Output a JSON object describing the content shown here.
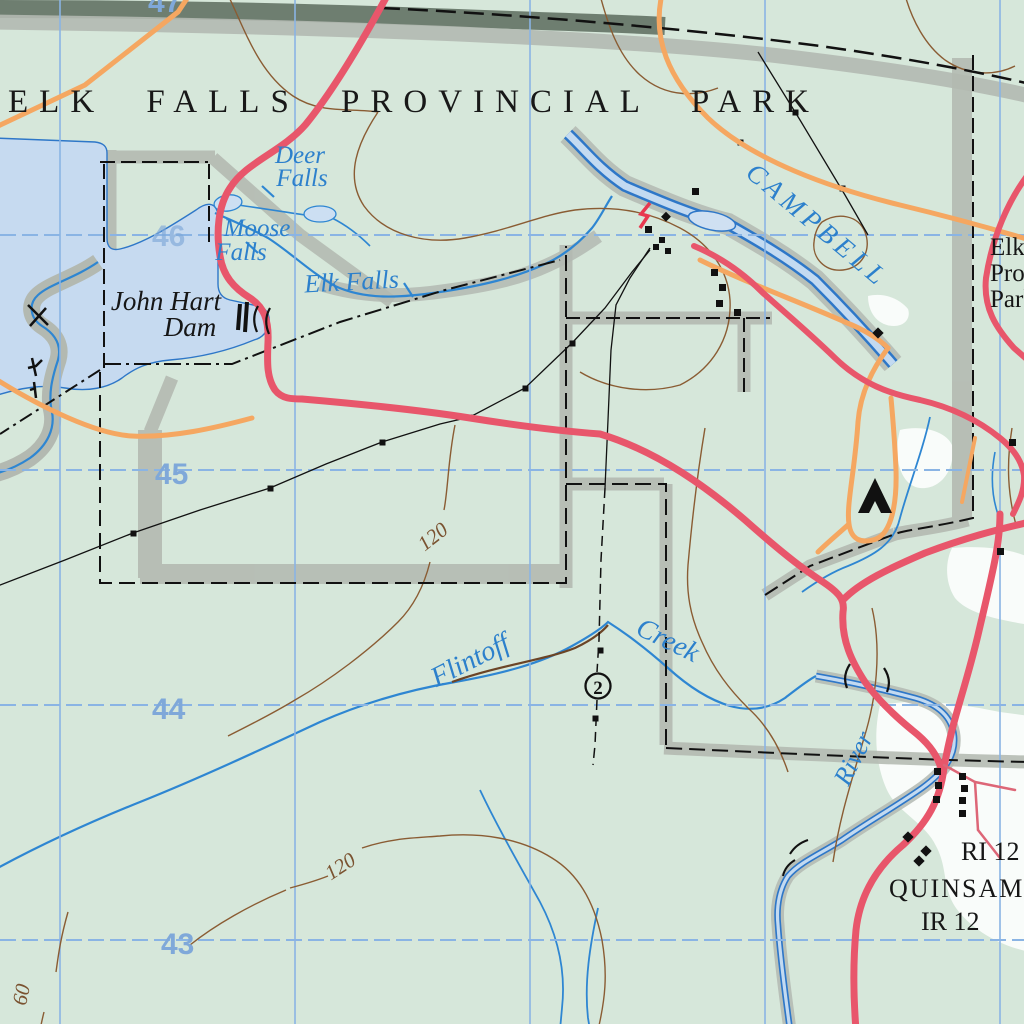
{
  "map": {
    "title": "ELK FALLS PROVINCIAL PARK",
    "grid": {
      "n47": "47",
      "n46": "46",
      "n45": "45",
      "n44": "44",
      "n43": "43"
    },
    "contours": {
      "c120a": "120",
      "c120b": "120",
      "c60": "60"
    },
    "hydro": {
      "deer1": "Deer",
      "deer2": "Falls",
      "moose1": "Moose",
      "moose2": "Falls",
      "elk_falls": "Elk Falls",
      "campbell": "CAMPBELL",
      "river": "River",
      "flintoff": "Flintoff",
      "creek": "Creek"
    },
    "places": {
      "john_hart1": "John Hart",
      "john_hart2": "Dam",
      "edge1": "Elk",
      "edge2": "Prov",
      "edge3": "Park",
      "ri12": "RI 12",
      "quinsam": "QUINSAM",
      "ir12": "IR 12"
    },
    "markers": {
      "route2": "2"
    },
    "colors": {
      "background": "#d6e7da",
      "lake_fill": "#c6daf0",
      "river_fill": "#c3daf1",
      "water_line": "#2e77c8",
      "label_blue": "#2c80cc",
      "grid_blue": "#8ab4e4",
      "road_red": "#e8566b",
      "road_thin_red": "#dd6677",
      "road_orange": "#f5a761",
      "boundary_gray": "#b3b9b1",
      "top_strip_green": "#6e7e70",
      "contour_brown": "#8a5c33",
      "boundary_black": "#111111"
    }
  }
}
